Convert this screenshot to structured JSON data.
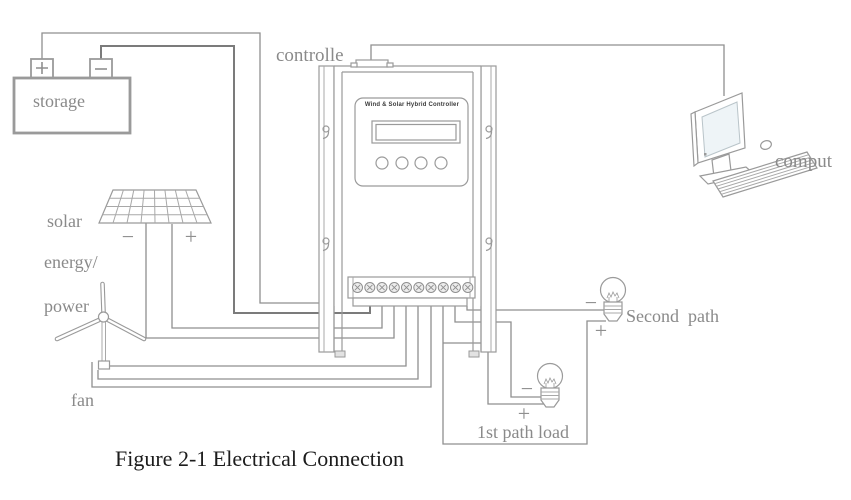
{
  "figure": {
    "caption": "Figure 2-1 Electrical Connection"
  },
  "labels": {
    "storage": "storage",
    "controller": "controlle",
    "computer": "comput",
    "solar_1": "solar",
    "solar_2": "energy/",
    "solar_3": "power",
    "fan": "fan",
    "second_path": "Second  path",
    "first_path_load": "1st path load",
    "panel_title": "Wind & Solar Hybrid Controller",
    "plus": "+",
    "minus": "−"
  },
  "controller": {
    "terminal_count": 10,
    "button_count": 4
  },
  "colors": {
    "wire": "#8f8f8f",
    "wire_dark": "#7b7b7b",
    "outline": "#9a9a9a",
    "label_text": "#8a8a8a",
    "caption_text": "#1c1c1c",
    "screen_fill": "#eef4f7"
  }
}
